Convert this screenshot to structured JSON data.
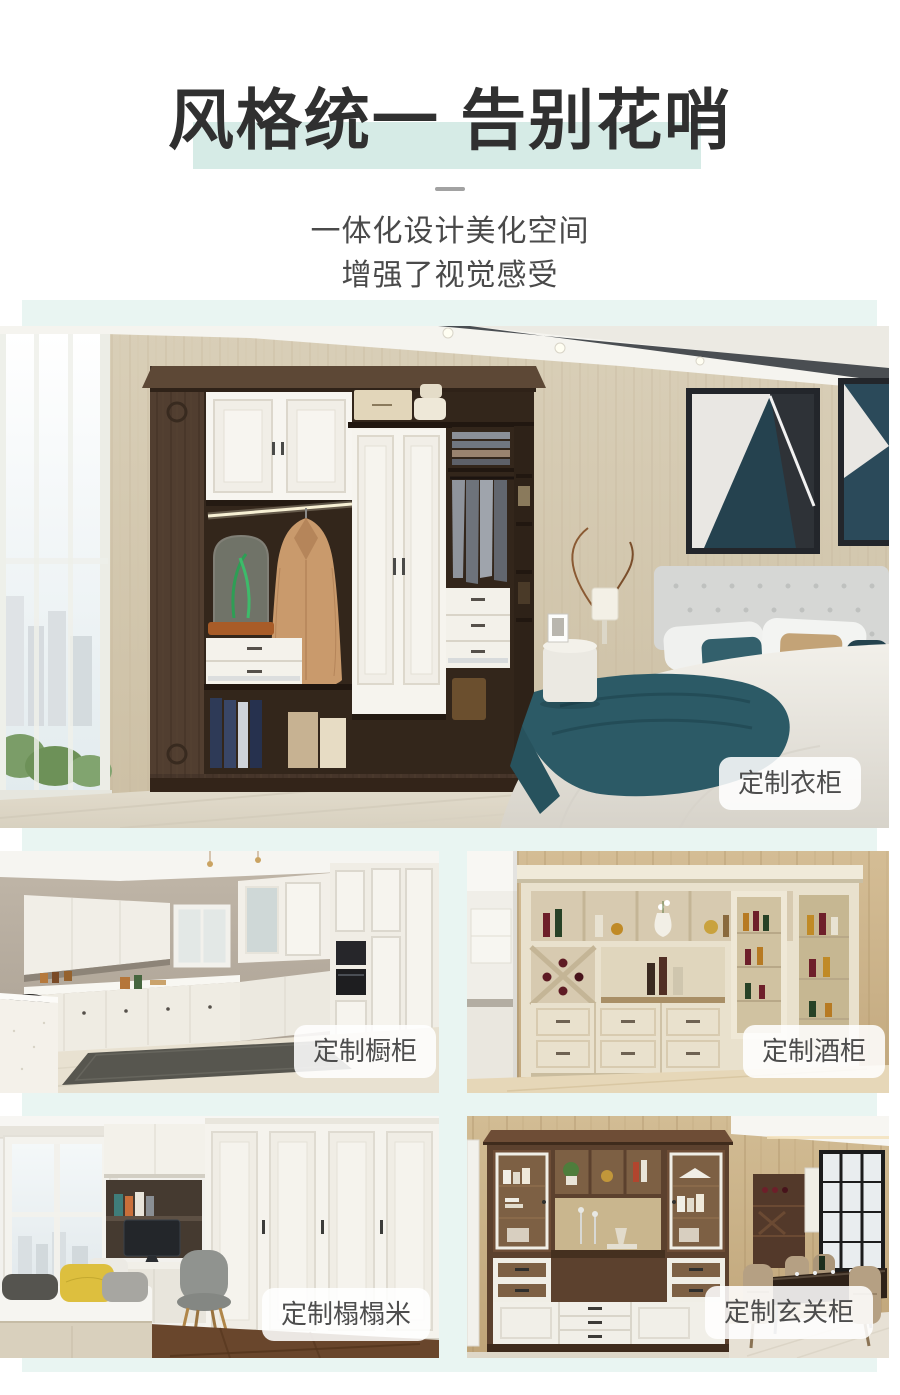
{
  "header": {
    "title": "风格统一 告别花哨",
    "subtitle_line1": "一体化设计美化空间",
    "subtitle_line2": "增强了视觉感受"
  },
  "gallery": {
    "hero": {
      "label": "定制衣柜"
    },
    "items": [
      {
        "label": "定制橱柜"
      },
      {
        "label": "定制酒柜"
      },
      {
        "label": "定制榻榻米"
      },
      {
        "label": "定制玄关柜"
      }
    ]
  },
  "colors": {
    "accent_panel": "#e9f5f2",
    "title_highlight": "#d6ebe6",
    "title_text": "#303030",
    "subtitle_text": "#4a4a4a",
    "label_pill_bg": "rgba(255,255,255,0.87)",
    "label_pill_text": "#4d4d4d"
  }
}
